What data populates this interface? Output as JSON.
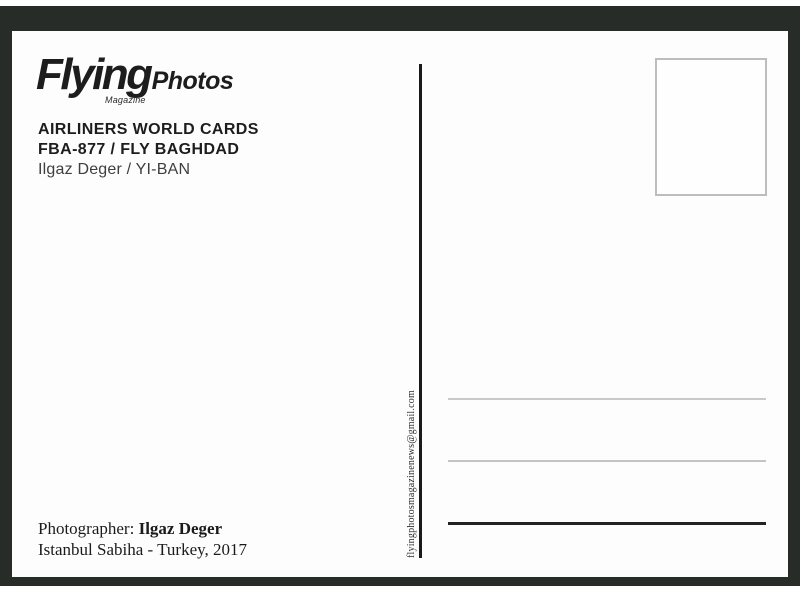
{
  "postcard": {
    "logo": {
      "brand": "Flying",
      "suffix": "Photos",
      "tagline": "Magazine"
    },
    "series": {
      "title": "AIRLINERS WORLD CARDS",
      "card_number": "FBA-877 / FLY BAGHDAD",
      "photographer_registration": "Ilgaz Deger / YI-BAN"
    },
    "contact": {
      "email": "flyingphotosmagazinenews@gmail.com"
    },
    "credit": {
      "label": "Photographer:",
      "name": "Ilgaz Deger",
      "location_year": "Istanbul Sabiha - Turkey, 2017"
    },
    "colors": {
      "frame": "#272c28",
      "card": "#fdfdfd",
      "ink": "#1d1d1d",
      "light_line": "#c9c9c9",
      "strong_line": "#232323",
      "stamp_border": "#bdbdbd"
    }
  }
}
